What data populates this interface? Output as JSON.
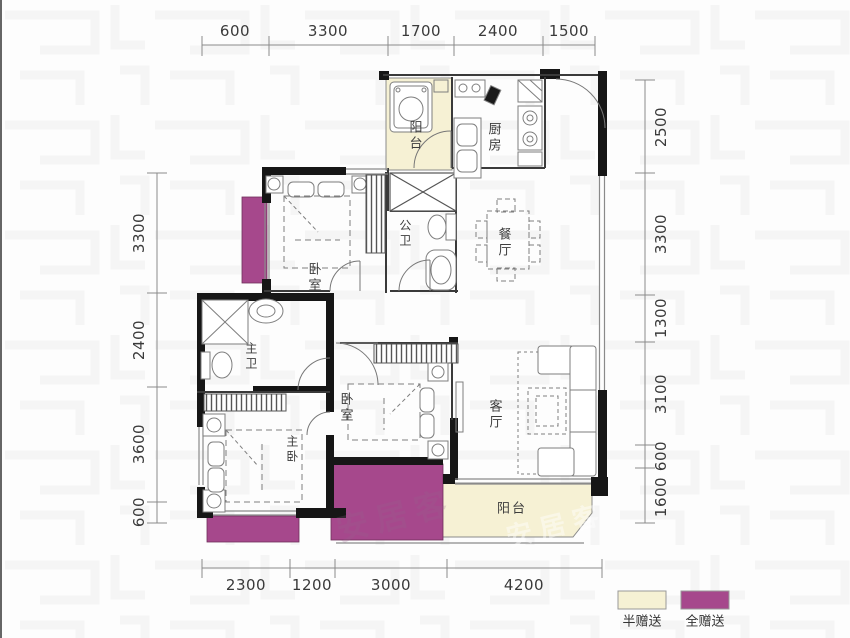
{
  "watermark": {
    "text": "安居客"
  },
  "rooms": {
    "balcony_top": {
      "label": "阳台"
    },
    "kitchen": {
      "label": "厨房"
    },
    "public_bath": {
      "label": "公卫"
    },
    "dining": {
      "label": "餐厅"
    },
    "bedroom_upper": {
      "label": "卧室"
    },
    "master_bath": {
      "label": "主卫"
    },
    "master_bedroom": {
      "label": "主卧"
    },
    "bedroom_middle": {
      "label": "卧室"
    },
    "living": {
      "label": "客厅"
    },
    "balcony_bottom": {
      "label": "阳台"
    }
  },
  "dimensions": {
    "top": [
      "600",
      "3300",
      "1700",
      "2400",
      "1500"
    ],
    "left": [
      "3300",
      "2400",
      "3600",
      "600"
    ],
    "right": [
      "2500",
      "3300",
      "1300",
      "3100",
      "600",
      "1600"
    ],
    "bottom": [
      "2300",
      "1200",
      "3000",
      "4200"
    ]
  },
  "legend": {
    "half": {
      "label": "半赠送",
      "color": "#F6F1D4"
    },
    "full": {
      "label": "全赠送",
      "color": "#A6488C"
    }
  },
  "colors": {
    "wall": "#161616",
    "line": "#555555"
  }
}
